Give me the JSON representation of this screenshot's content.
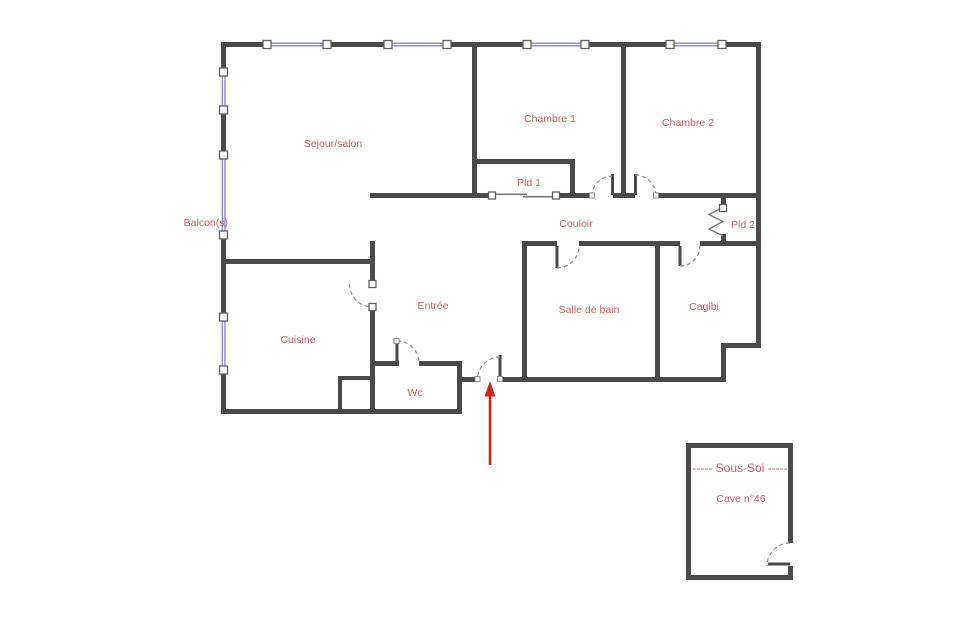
{
  "palette": {
    "wall": "#4a4a4a",
    "window_line": "#8585d0",
    "window_frame": "#5f5f5f",
    "door": "#8f8f8f",
    "label": "#c9605c",
    "arrow": "#cf241c"
  },
  "rooms": {
    "sejour": "Sejour/salon",
    "balcon": "Balcon(s)",
    "chambre1": "Chambre 1",
    "chambre2": "Chambre 2",
    "pld1": "Pld 1",
    "pld2": "Pld 2",
    "couloir": "Couloir",
    "cuisine": "Cuisine",
    "entree": "Entrée",
    "salle_de_bain": "Salle de bain",
    "cagibi": "Cagibi",
    "wc": "Wc"
  },
  "basement": {
    "title": "----- Sous-Sol -----",
    "label": "Cave n°46"
  }
}
